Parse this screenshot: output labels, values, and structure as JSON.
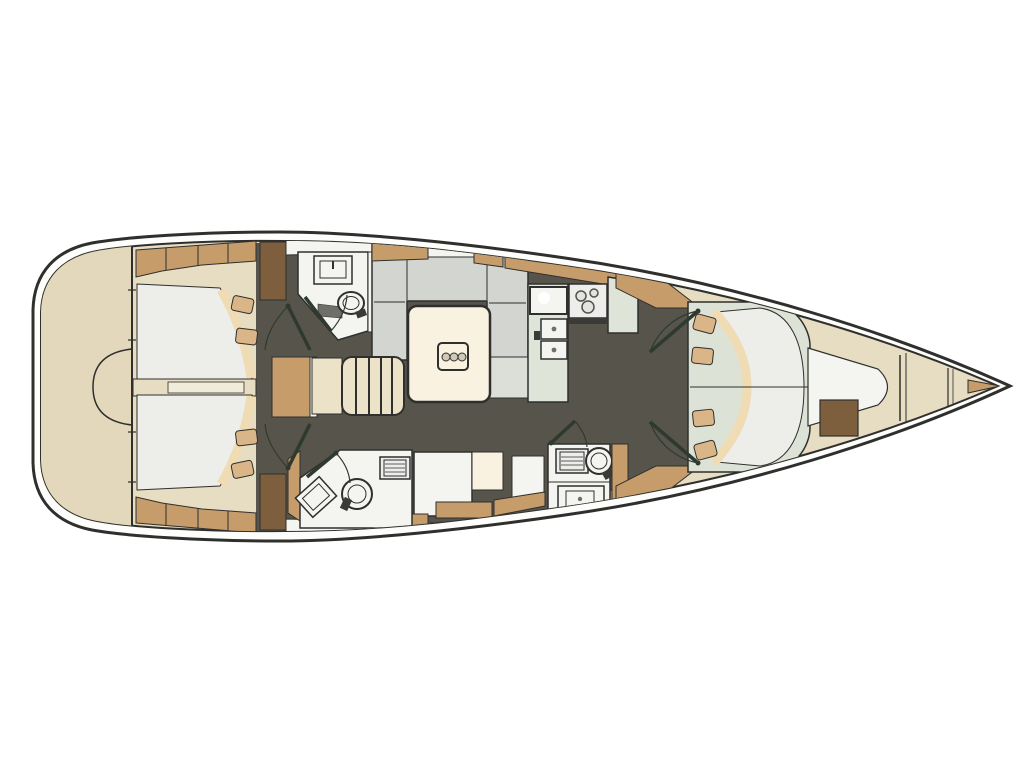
{
  "diagram": {
    "kind": "sailing-yacht-interior-deck-plan",
    "orientation": "top view, bow pointing right, stern at left",
    "areas": [
      "stern-platform",
      "aft-double-cabin-top",
      "aft-double-cabin-bottom",
      "head-top-with-sink-and-toilet",
      "companionway-stairs",
      "u-shaped-salon-sofa",
      "salon-table-with-bottle-holder",
      "galley-with-sink-double-sink-and-three-burner-stove",
      "nav-station-desk-and-seat",
      "head-bottom-left-with-sink-toilet-shower-grate",
      "head-bottom-right-with-shower-grate-toilet-sink",
      "bow-owner-cabin-double-berth-four-pillows",
      "bow-cabin-seat",
      "anchor-locker"
    ]
  },
  "colors": {
    "background": "#ffffff",
    "outline": "#2f2f2d",
    "hull_white": "#fdfdfb",
    "interior_cream": "#e7ddc2",
    "cream_light": "#f1ebd9",
    "stern_cream": "#e3d8bb",
    "floor_dark": "#57544c",
    "teak": "#c69c6b",
    "teak_dark": "#7d5f3e",
    "sofa_gray": "#d3d5d1",
    "bench_gray": "#dcded8",
    "white_surface": "#f4f4f1",
    "counter_sage": "#dfe4d9",
    "mattress_white": "#edeeea",
    "bed_base_sage": "#dce2d5",
    "pillow_tan": "#d9b588",
    "spread_cream": "#f0dcb4",
    "table_cream": "#f9f2e1",
    "table_holder_gray": "#cfc9b8",
    "stairs_cream": "#ece2c8",
    "appliance_white": "#ededeb",
    "appliance_dark": "#3a3a38",
    "burner_gray": "#e3e3df",
    "accent_detail": "#6f6f69",
    "door_line": "#2e3a2e"
  }
}
